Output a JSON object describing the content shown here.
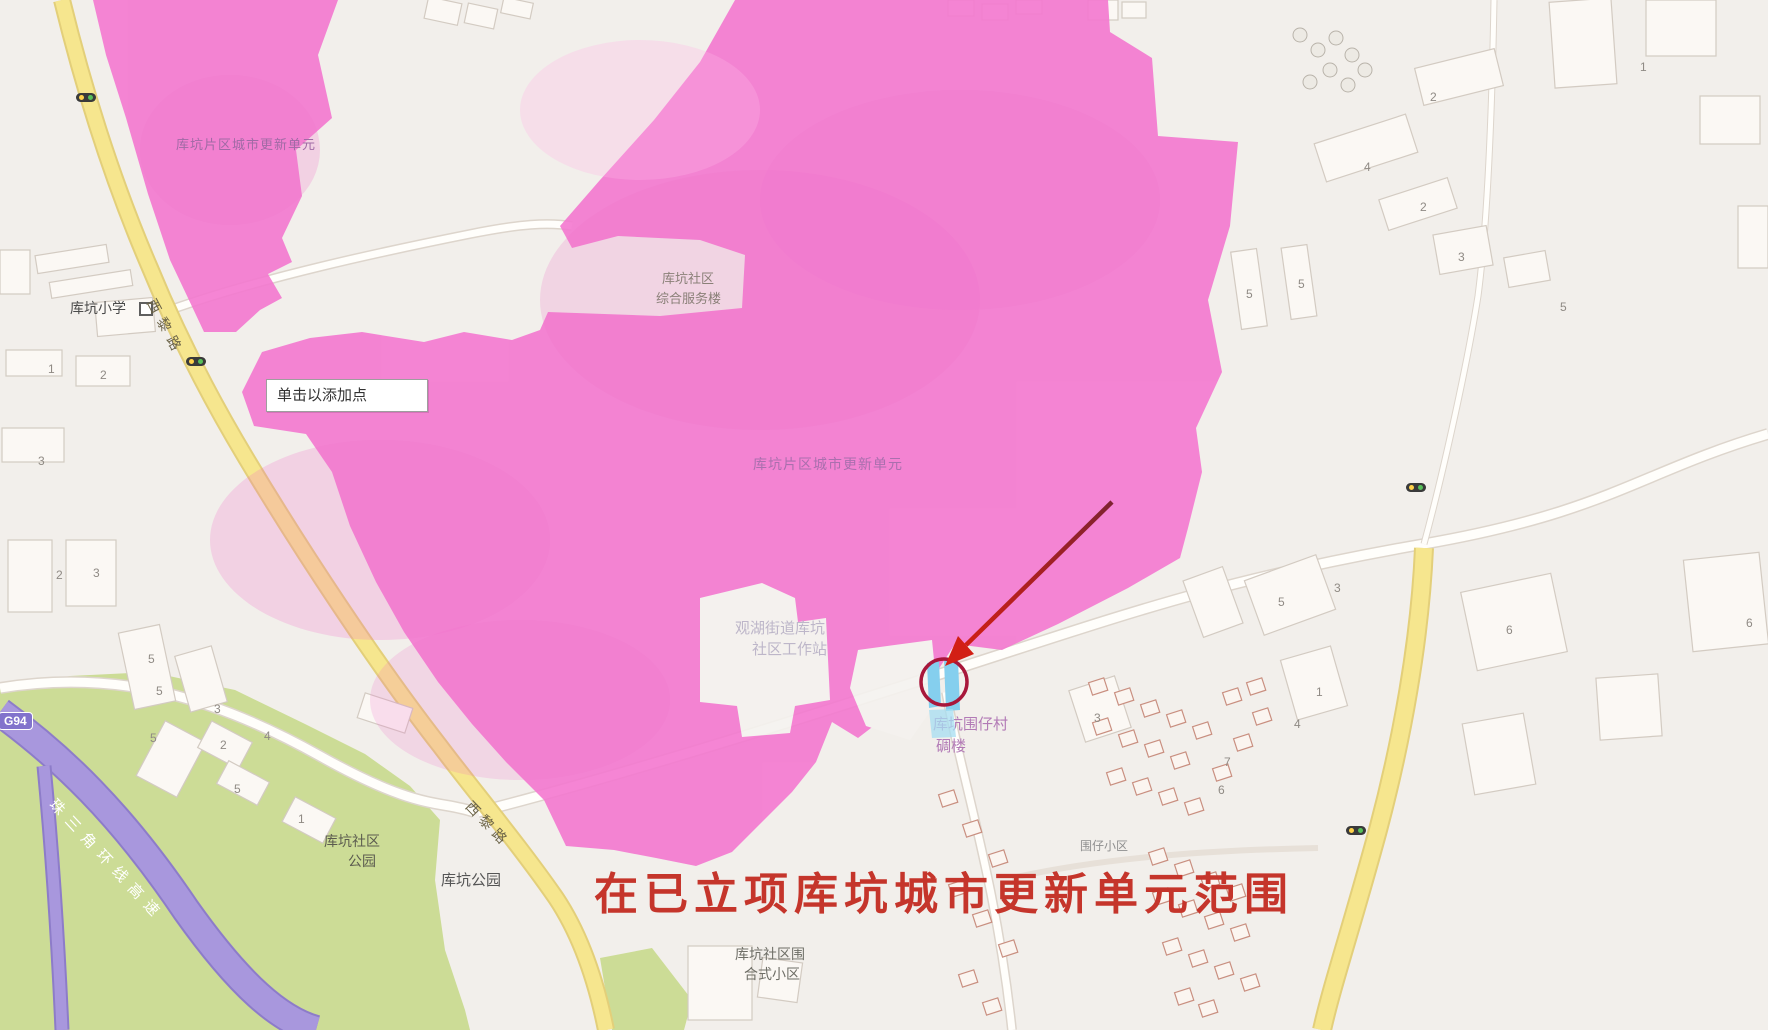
{
  "tooltip": {
    "text": "单击以添加点"
  },
  "caption": {
    "text": "在已立项库坑城市更新单元范围",
    "color": "#c5352b"
  },
  "overlay": {
    "fill": "#f478d0",
    "unit_label_nw": "库坑片区城市更新单元",
    "unit_label_center": "库坑片区城市更新单元"
  },
  "map": {
    "labels": {
      "school": "库坑小学",
      "service_line1": "库坑社区",
      "service_line2": "综合服务楼",
      "workstation_line1": "观湖街道库坑",
      "workstation_line2": "社区工作站",
      "diaolou_line1": "库坑围仔村",
      "diaolou_line2": "碉楼",
      "park_community_line1": "库坑社区",
      "park_community_line2": "公园",
      "park": "库坑公园",
      "estate_line1": "库坑社区围",
      "estate_line2": "合式小区",
      "weizai": "围仔小区"
    },
    "roads": {
      "xili_1": "西黎路",
      "xili_2": "西黎路",
      "expressway": "珠三角环线高速",
      "shield": "G94"
    },
    "numbers": [
      {
        "t": "1",
        "x": 48,
        "y": 362
      },
      {
        "t": "2",
        "x": 100,
        "y": 368
      },
      {
        "t": "3",
        "x": 38,
        "y": 454
      },
      {
        "t": "2",
        "x": 56,
        "y": 568
      },
      {
        "t": "3",
        "x": 93,
        "y": 566
      },
      {
        "t": "5",
        "x": 148,
        "y": 652
      },
      {
        "t": "5",
        "x": 156,
        "y": 684
      },
      {
        "t": "3",
        "x": 214,
        "y": 702
      },
      {
        "t": "5",
        "x": 150,
        "y": 731
      },
      {
        "t": "2",
        "x": 220,
        "y": 738
      },
      {
        "t": "5",
        "x": 234,
        "y": 782
      },
      {
        "t": "4",
        "x": 264,
        "y": 729
      },
      {
        "t": "1",
        "x": 298,
        "y": 812
      },
      {
        "t": "4",
        "x": 1364,
        "y": 160
      },
      {
        "t": "2",
        "x": 1420,
        "y": 200
      },
      {
        "t": "5",
        "x": 1246,
        "y": 287
      },
      {
        "t": "5",
        "x": 1298,
        "y": 277
      },
      {
        "t": "3",
        "x": 1458,
        "y": 250
      },
      {
        "t": "3",
        "x": 1334,
        "y": 581
      },
      {
        "t": "5",
        "x": 1278,
        "y": 595
      },
      {
        "t": "6",
        "x": 1506,
        "y": 623
      },
      {
        "t": "1",
        "x": 1316,
        "y": 685
      },
      {
        "t": "4",
        "x": 1294,
        "y": 717
      },
      {
        "t": "3",
        "x": 1094,
        "y": 711
      },
      {
        "t": "6",
        "x": 1218,
        "y": 783
      },
      {
        "t": "7",
        "x": 1224,
        "y": 755
      },
      {
        "t": "6",
        "x": 1746,
        "y": 616
      },
      {
        "t": "2",
        "x": 1430,
        "y": 90
      },
      {
        "t": "5",
        "x": 1560,
        "y": 300
      },
      {
        "t": "1",
        "x": 1640,
        "y": 60
      }
    ],
    "colors": {
      "road_yellow": "#f6e68e",
      "expressway_purple": "#a897dd",
      "park_green": "#ccdc96",
      "overlay_pink": "#f478d0",
      "marker_blue": "#85cfee",
      "arrow_red": "#d21f14",
      "circle_red": "#a8173b"
    }
  }
}
